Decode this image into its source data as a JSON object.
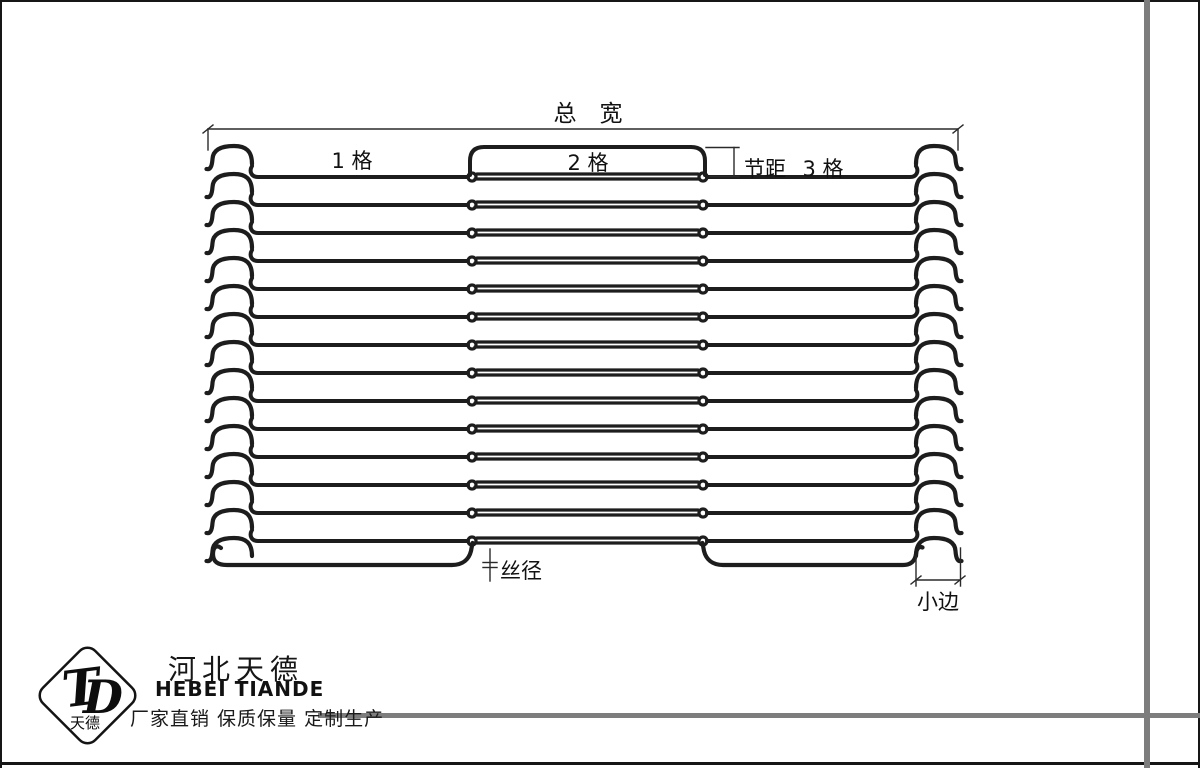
{
  "page": {
    "background": "#ffffff",
    "wire_color": "#1d1d1d",
    "dim_color": "#2a2a2a",
    "accent_gray": "#7d7d7d"
  },
  "diagram": {
    "labels": {
      "total_width": "总　宽",
      "section1": "1 格",
      "section2": "2 格",
      "pitch": "节距",
      "section3": "3 格",
      "wire_diameter": "丝径",
      "small_edge": "小边"
    }
  },
  "footer": {
    "logo": {
      "t_letter": "T",
      "d_letter": "D",
      "caption": "天德"
    },
    "company_cn": "河北天德",
    "company_en": "HEBEI TIANDE",
    "tagline": "厂家直销 保质保量 定制生产"
  }
}
